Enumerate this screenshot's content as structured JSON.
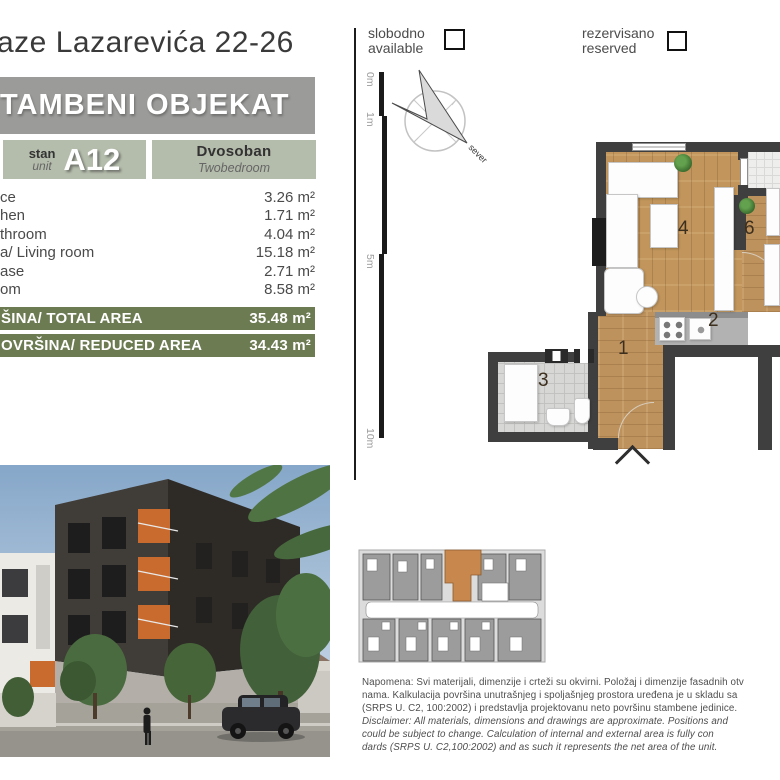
{
  "page": {
    "address": "aze Lazarevića 22-26",
    "building_type": "TAMBENI OBJEKAT"
  },
  "unit_card": {
    "stan_label": "stan",
    "unit_label": "unit",
    "unit_code": "A12",
    "type_sr": "Dvosoban",
    "type_en": "Twobedroom"
  },
  "rooms": [
    {
      "label": "ce",
      "area": "3.26 m²"
    },
    {
      "label": "hen",
      "area": "1.71 m²"
    },
    {
      "label": "throom",
      "area": "4.04 m²"
    },
    {
      "label": "a/ Living room",
      "area": "15.18 m²"
    },
    {
      "label": "ase",
      "area": "2.71 m²"
    },
    {
      "label": "om",
      "area": "8.58 m²"
    }
  ],
  "totals": [
    {
      "label": "ŠINA/ TOTAL AREA",
      "value": "35.48 m²"
    },
    {
      "label": "OVRŠINA/ REDUCED AREA",
      "value": "34.43 m²"
    }
  ],
  "legend": {
    "available_sr": "slobodno",
    "available_en": "available",
    "reserved_sr": "rezervisano",
    "reserved_en": "reserved"
  },
  "compass": {
    "label": "sever"
  },
  "scale_ruler": {
    "marks": [
      "0m",
      "1m",
      "5m",
      "10m"
    ]
  },
  "floor_plan": {
    "numbers": {
      "hall": "1",
      "kitchen": "2",
      "bathroom": "3",
      "living": "4",
      "bedroom": "6"
    }
  },
  "disclaimer": {
    "lines": [
      "Napomena: Svi materijali, dimenzije i crteži su okvirni. Položaj i dimenzije fasadnih otv",
      "nama. Kalkulacija površina unutrašnjeg i spoljašnjeg prostora uređena je u skladu sa",
      "(SRPS U. C2, 100:2002) i predstavlja projektovanu neto površinu stambene jedinice.",
      "Disclaimer: All materials, dimensions and drawings are approximate. Positions and",
      "could be subject to change. Calculation of internal and external area is fully con",
      "dards (SRPS U. C2,100:2002) and as such it represents the net area of the unit."
    ]
  },
  "colors": {
    "accent_olive": "#6d7b52",
    "cell_sage": "#b4bcab",
    "header_gray": "#9b9b99",
    "wood": "#c79a5f",
    "keyplan_highlight": "#c8884d"
  }
}
